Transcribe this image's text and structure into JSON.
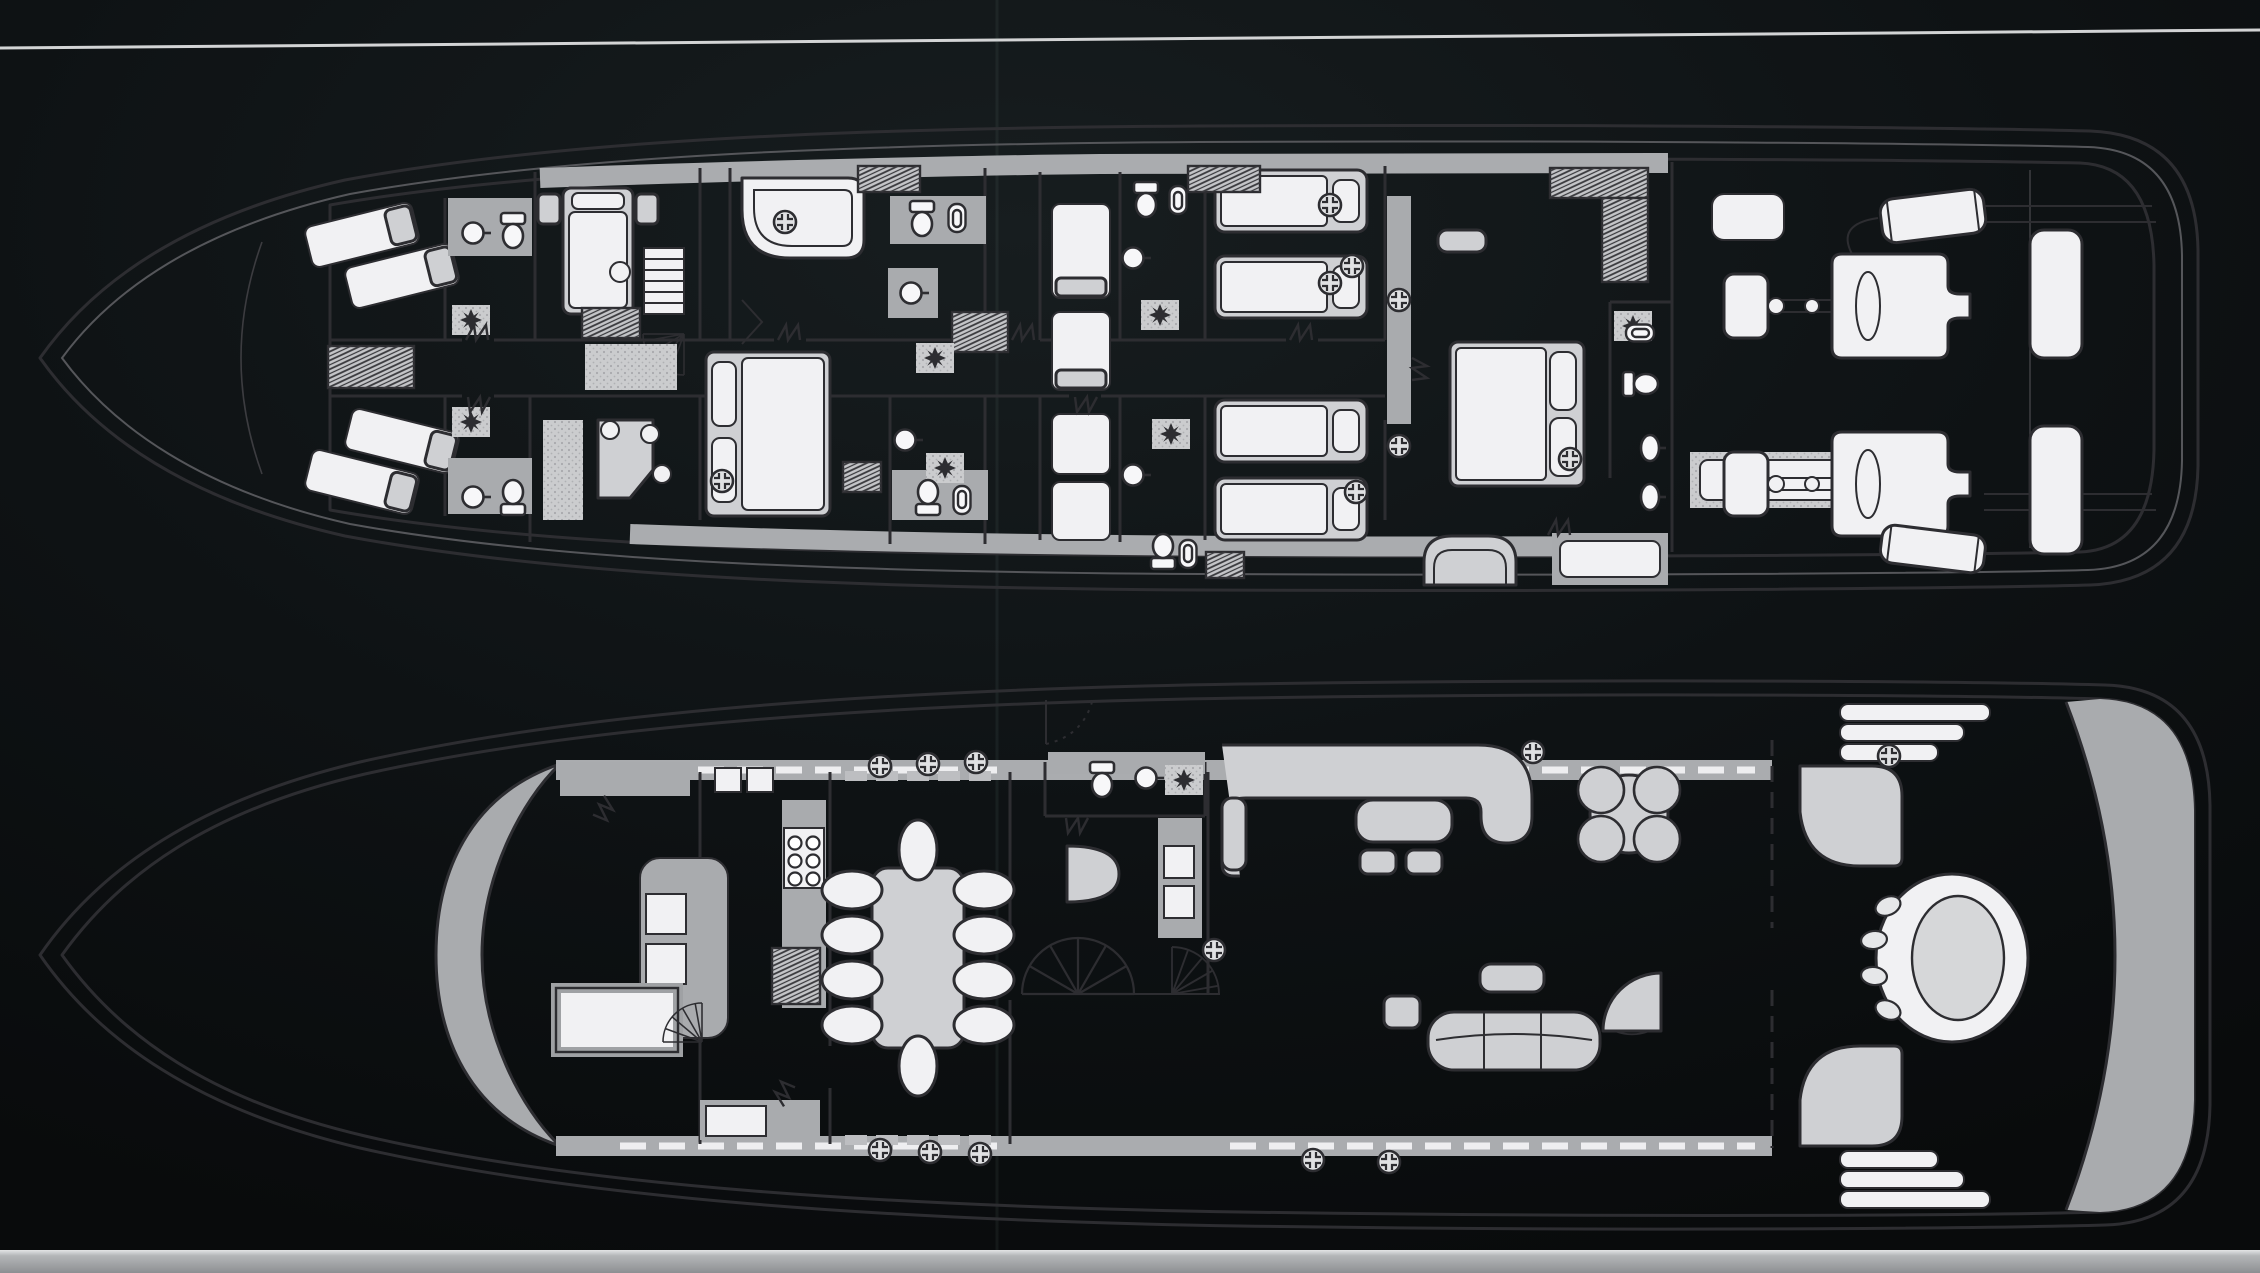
{
  "meta": {
    "content": "Scanned brochure page showing a motor yacht's two deck plans (top-view floor plans) in black-and-white line drawing on a black background",
    "visible_text": "none"
  },
  "colors": {
    "background": "#0b0e10",
    "hull_band": "#b3b5b7",
    "interior": "#f1f1f3",
    "walls": "#a9abae",
    "furniture": "#cfd0d3",
    "linework": "#2d2d31",
    "page_edge_band": "#94969a",
    "scan_line": "#e8e9ea"
  },
  "scan_artifacts": {
    "white_line_from": [
      0,
      48
    ],
    "white_line_to": [
      2260,
      30
    ],
    "vertical_crease_x": 997,
    "bottom_band_y": 1250
  },
  "decks": [
    {
      "id": "lower-deck",
      "position": "top",
      "areas": [
        "forepeak",
        "crew cabins with angled berths",
        "two crew shower rooms",
        "forward guest double cabin",
        "crew mess with desk",
        "captain double cabin",
        "forward bathroom with corner tub",
        "two twin guest cabins port and starboard pairs",
        "guest bathrooms with toilet and bidet",
        "master stateroom with double bed, bench, vanity and sofa",
        "master bathroom with twin basins",
        "engine room with twin engines, gearboxes, mufflers and fuel tanks"
      ],
      "counts": {
        "single_berths": 12,
        "double_berths": 3,
        "toilets": 7,
        "bidets": 5,
        "washbasins": 8,
        "dressing_stools": 7,
        "engines": 2,
        "fuel_tanks": 2,
        "staircases": 1
      },
      "fixtures": {
        "portholes": [
          [
            785,
            222
          ],
          [
            722,
            481
          ],
          [
            1330,
            205
          ],
          [
            1330,
            283
          ],
          [
            1352,
            266
          ],
          [
            1399,
            300
          ],
          [
            1399,
            446
          ],
          [
            1356,
            492
          ],
          [
            1570,
            459
          ]
        ],
        "star_stools": [
          [
            471,
            320
          ],
          [
            471,
            422
          ],
          [
            935,
            358
          ],
          [
            945,
            468
          ],
          [
            1160,
            315
          ],
          [
            1171,
            434
          ],
          [
            1633,
            326
          ]
        ],
        "toilets": [
          [
            513,
            231,
            0
          ],
          [
            513,
            497,
            180
          ],
          [
            922,
            219,
            0
          ],
          [
            928,
            497,
            180
          ],
          [
            1146,
            200,
            0
          ],
          [
            1163,
            551,
            180
          ],
          [
            1641,
            384,
            -90
          ]
        ],
        "bidets": [
          [
            957,
            219,
            0
          ],
          [
            962,
            499,
            180
          ],
          [
            1178,
            201,
            0
          ],
          [
            1188,
            553,
            180
          ],
          [
            1641,
            333,
            -90
          ]
        ],
        "sinks_round": [
          [
            473,
            233
          ],
          [
            473,
            497
          ],
          [
            911,
            293
          ],
          [
            905,
            440
          ],
          [
            1133,
            258
          ],
          [
            1133,
            475
          ]
        ],
        "sinks_oval": [
          [
            1650,
            448
          ],
          [
            1650,
            497
          ]
        ],
        "door_marks": [
          [
            478,
            340,
            0
          ],
          [
            478,
            397,
            180
          ],
          [
            790,
            340,
            0
          ],
          [
            1024,
            340,
            0
          ],
          [
            1085,
            397,
            180
          ],
          [
            1302,
            340,
            0
          ],
          [
            1412,
            370,
            90
          ],
          [
            1560,
            535,
            0
          ]
        ]
      }
    },
    {
      "id": "main-deck",
      "position": "bottom",
      "areas": [
        "foredeck",
        "wheelhouse with raked windshield, console, chart table and stair down",
        "galley with six-burner stove and counters",
        "dining room with table for ten",
        "day head",
        "lobby with bar, cabinets and twin stairways",
        "main salon with L-settee, coffee table, ottomans, card table and long sofa",
        "aft deck with curved corner benches and round table",
        "twin quarter stairways",
        "curved transom"
      ],
      "counts": {
        "dining_chairs": 10,
        "stove_burners": 6,
        "card_table_chairs": 4,
        "aft_table_seats": 4,
        "staircases": 4
      },
      "fixtures": {
        "portholes": [
          [
            880,
            766
          ],
          [
            928,
            764
          ],
          [
            976,
            762
          ],
          [
            880,
            1150
          ],
          [
            930,
            1152
          ],
          [
            980,
            1154
          ],
          [
            1214,
            950
          ],
          [
            1533,
            752
          ],
          [
            1313,
            1160
          ],
          [
            1389,
            1162
          ],
          [
            1889,
            756
          ]
        ],
        "star_stools": [
          [
            1184,
            780
          ]
        ],
        "toilets": [
          [
            1102,
            780,
            0
          ]
        ],
        "bidets": [],
        "sinks_round": [
          [
            1146,
            778
          ]
        ],
        "sinks_oval": [],
        "dining_chairs": [
          [
            852,
            890,
            0
          ],
          [
            852,
            935,
            0
          ],
          [
            852,
            980,
            0
          ],
          [
            852,
            1025,
            0
          ],
          [
            984,
            890,
            0
          ],
          [
            984,
            935,
            0
          ],
          [
            984,
            980,
            0
          ],
          [
            984,
            1025,
            0
          ],
          [
            918,
            850,
            90
          ],
          [
            918,
            1066,
            90
          ]
        ],
        "game_chairs": [
          [
            1601,
            790
          ],
          [
            1657,
            790
          ],
          [
            1601,
            839
          ],
          [
            1657,
            839
          ]
        ],
        "stove_burners": [
          [
            795,
            843
          ],
          [
            813,
            843
          ],
          [
            795,
            861
          ],
          [
            813,
            861
          ],
          [
            795,
            879
          ],
          [
            813,
            879
          ]
        ],
        "aft_table_seats": [
          [
            1888,
            906,
            -24
          ],
          [
            1874,
            940,
            -8
          ],
          [
            1874,
            976,
            8
          ],
          [
            1888,
            1010,
            24
          ]
        ],
        "door_marks": [
          [
            598,
            806,
            120
          ],
          [
            790,
            1096,
            -60
          ],
          [
            1076,
            818,
            180
          ]
        ]
      }
    }
  ]
}
